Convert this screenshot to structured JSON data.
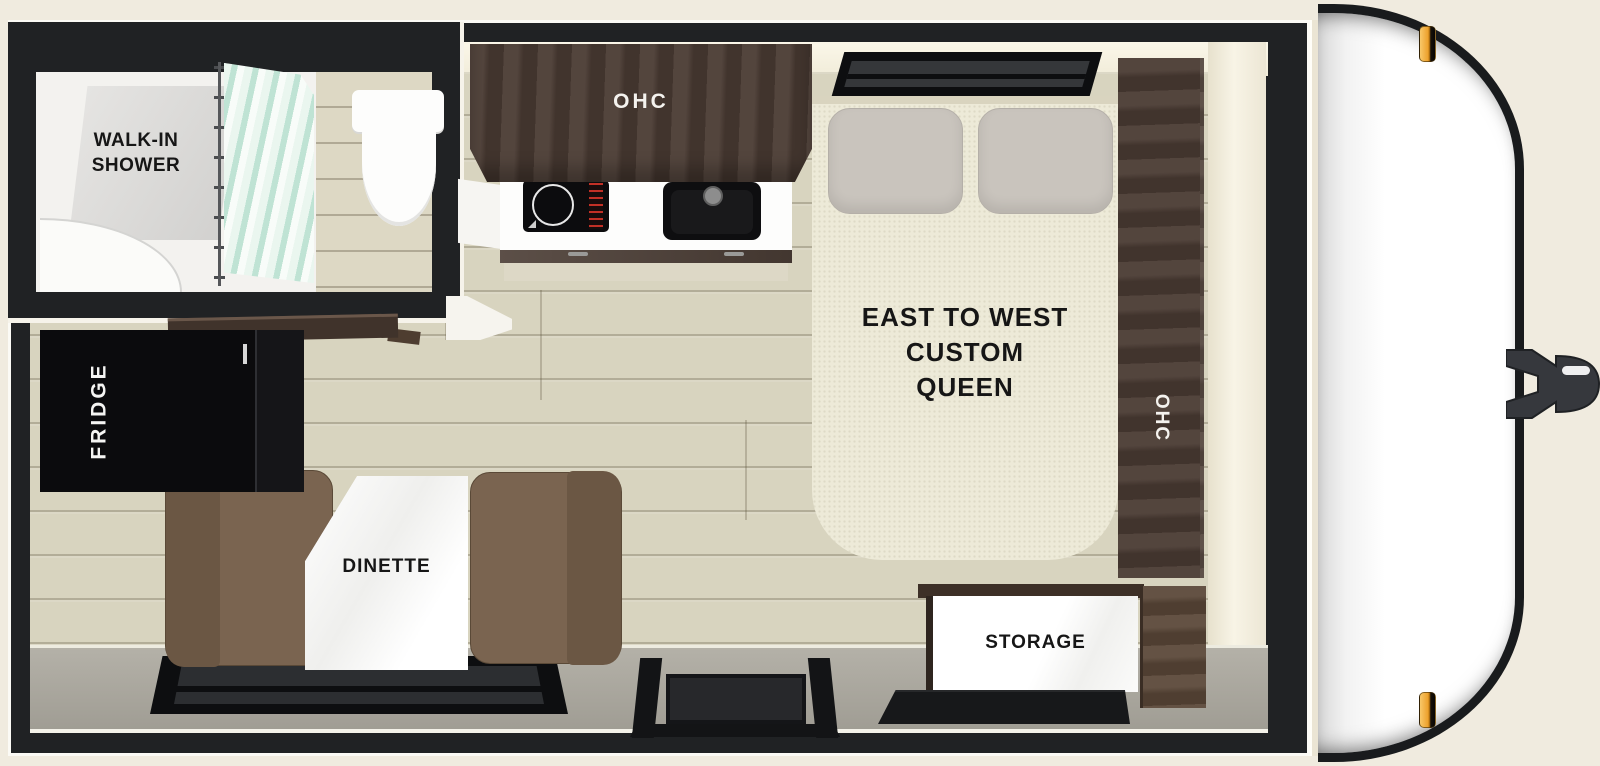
{
  "diagram": {
    "kind": "travel-trailer-floorplan",
    "view": "top-down"
  },
  "labels": {
    "bathroom_line1": "WALK-IN",
    "bathroom_line2": "SHOWER",
    "kitchen_ohc": "OHC",
    "bed_line1": "EAST TO WEST",
    "bed_line2": "CUSTOM",
    "bed_line3": "QUEEN",
    "bedside_ohc": "OHC",
    "fridge": "FRIDGE",
    "dinette": "DINETTE",
    "storage": "STORAGE"
  },
  "fixtures": {
    "bathroom": [
      "shower-curtain",
      "shower-pan",
      "toilet"
    ],
    "kitchen": [
      "overhead-cabinet",
      "cooktop",
      "sink",
      "counter"
    ],
    "bedroom": [
      "bed-window",
      "pillow",
      "pillow",
      "side-overhead-cabinet"
    ],
    "galley": [
      "countertop",
      "refrigerator"
    ],
    "dinette": [
      "bench-seat",
      "bench-seat",
      "table",
      "window"
    ],
    "entry": [
      "entry-door",
      "step",
      "step-mat"
    ],
    "storage_area": [
      "storage-box",
      "wardrobe"
    ],
    "exterior": [
      "front-cap",
      "marker-light-top",
      "marker-light-bottom",
      "tongue-hitch"
    ]
  },
  "colors": {
    "background_cream": "#f0ebdf",
    "wall_dark": "#202224",
    "floor_wood": "#d8d4bf",
    "cabinet_wood_dark": "#4a3b33",
    "mattress_cream": "#edead8",
    "pillow_gray": "#c9c4bd",
    "cushion_brown": "#7a6450",
    "bottom_wall_gray": "#a9a69d",
    "appliance_black": "#0d0d0f",
    "shower_curtain_mint": "#cde9dc",
    "trailer_body_white": "#ffffff",
    "marker_light_amber": "#eda22e"
  }
}
